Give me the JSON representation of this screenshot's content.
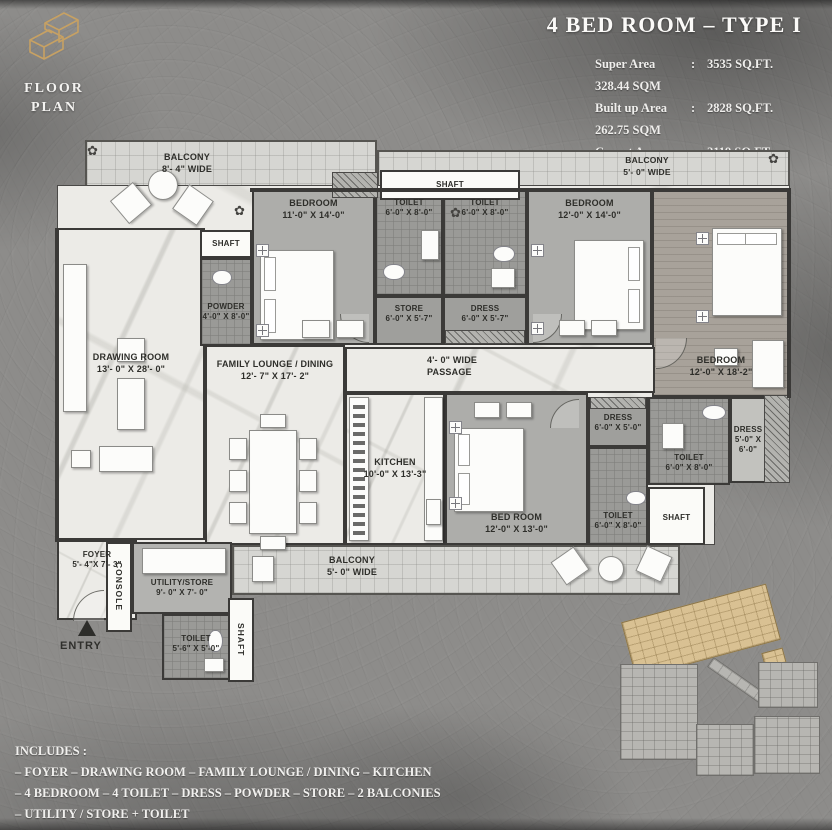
{
  "colors": {
    "background": "#8d8c8a",
    "accent_gold": "#c7a163",
    "wall": "#3b3a38",
    "keyplan_highlight": "#d9c193"
  },
  "icons": {
    "rosette": "✿",
    "logo": "isometric-cube-monogram"
  },
  "branding": {
    "floor_plan_label": "FLOOR PLAN"
  },
  "header": {
    "title": "4 BED ROOM – TYPE I",
    "colon": ":",
    "areas": [
      {
        "label": "Super Area",
        "sqft": "3535 SQ.FT.",
        "sqm": "328.44 SQM"
      },
      {
        "label": "Built up Area",
        "sqft": "2828 SQ.FT.",
        "sqm": "262.75 SQM"
      },
      {
        "label": "Carpet Area",
        "sqft": "2119 SQ.FT.",
        "sqm": "196.96 SQM"
      }
    ]
  },
  "plan": {
    "rooms": {
      "balcony_top_left": {
        "label": "BALCONY",
        "dims": "8'- 4\" WIDE"
      },
      "shaft_top": {
        "label": "SHAFT"
      },
      "balcony_top_right": {
        "label": "BALCONY",
        "dims": "5'- 0\" WIDE"
      },
      "bedroom1": {
        "label": "BEDROOM",
        "dims": "11'-0\" X 14'-0\""
      },
      "toilet1": {
        "label": "TOILET",
        "dims": "6'-0\" X 8'-0\""
      },
      "store": {
        "label": "STORE",
        "dims": "6'-0\" X 5'-7\""
      },
      "toilet2": {
        "label": "TOILET",
        "dims": "6'-0\" X 8'-0\""
      },
      "dress1": {
        "label": "DRESS",
        "dims": "6'-0\" X 5'-7\""
      },
      "bedroom2": {
        "label": "BEDROOM",
        "dims": "12'-0\" X 14'-0\""
      },
      "bedroom3": {
        "label": "BEDROOM",
        "dims": "12'-0\" X 18'-2\""
      },
      "shaft_left": {
        "label": "SHAFT"
      },
      "powder": {
        "label": "POWDER",
        "dims": "4'-0\" X 8'-0\""
      },
      "drawing_room": {
        "label": "DRAWING ROOM",
        "dims": "13'- 0\" X 28'- 0\""
      },
      "family_lounge": {
        "label": "FAMILY LOUNGE / DINING",
        "dims": "12'- 7\" X 17'- 2\""
      },
      "passage": {
        "label": "4'- 0\" WIDE PASSAGE"
      },
      "kitchen": {
        "label": "KITCHEN",
        "dims": "10'-0\" X 13'-3\""
      },
      "bedroom4": {
        "label": "BED ROOM",
        "dims": "12'-0\" X 13'-0\""
      },
      "dress2": {
        "label": "DRESS",
        "dims": "6'-0\" X 5'-0\""
      },
      "toilet3": {
        "label": "TOILET",
        "dims": "6'-0\" X 8'-0\""
      },
      "dress3": {
        "label": "DRESS",
        "dims": "5'-0\" X 6'-0\""
      },
      "toilet4": {
        "label": "TOILET",
        "dims": "6'-0\" X 8'-0\""
      },
      "shaft_right": {
        "label": "SHAFT"
      },
      "balcony_bottom": {
        "label": "BALCONY",
        "dims": "5'- 0\" WIDE"
      },
      "foyer": {
        "label": "FOYER",
        "dims": "5'- 4\"X 7'- 3\""
      },
      "console": {
        "label": "CONSOLE"
      },
      "utility": {
        "label": "UTILITY/STORE",
        "dims": "9'- 0\" X 7'- 0\""
      },
      "toilet5": {
        "label": "TOILET",
        "dims": "5'-6\" X 5'-0\""
      },
      "shaft_bottom": {
        "label": "SHAFT"
      },
      "entry": {
        "label": "ENTRY"
      }
    }
  },
  "includes": {
    "heading": "INCLUDES :",
    "lines": [
      "– FOYER – DRAWING ROOM – FAMILY LOUNGE / DINING – KITCHEN",
      "– 4 BEDROOM – 4 TOILET – DRESS – POWDER – STORE – 2 BALCONIES",
      "– UTILITY / STORE + TOILET"
    ]
  }
}
